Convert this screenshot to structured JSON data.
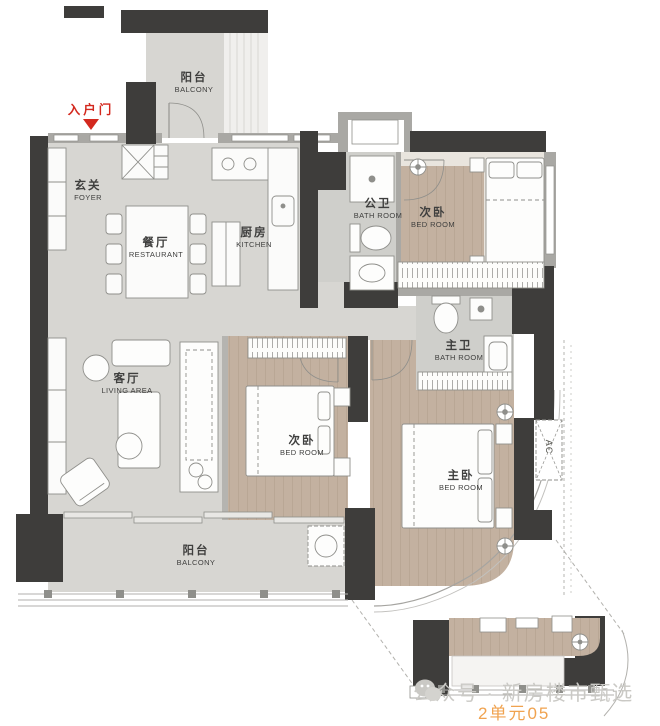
{
  "plan": {
    "entrance_label": "入户门",
    "ac_label": "AC",
    "rooms": [
      {
        "id": "balcony-top",
        "zh": "阳台",
        "en": "BALCONY"
      },
      {
        "id": "foyer",
        "zh": "玄关",
        "en": "FOYER"
      },
      {
        "id": "dining",
        "zh": "餐厅",
        "en": "RESTAURANT"
      },
      {
        "id": "kitchen",
        "zh": "厨房",
        "en": "KITCHEN"
      },
      {
        "id": "bath-public",
        "zh": "公卫",
        "en": "BATH ROOM"
      },
      {
        "id": "bedroom-second-top",
        "zh": "次卧",
        "en": "BED ROOM"
      },
      {
        "id": "bath-master",
        "zh": "主卫",
        "en": "BATH ROOM"
      },
      {
        "id": "living",
        "zh": "客厅",
        "en": "LIVING AREA"
      },
      {
        "id": "bedroom-second-mid",
        "zh": "次卧",
        "en": "BED ROOM"
      },
      {
        "id": "bedroom-master",
        "zh": "主卧",
        "en": "BED ROOM"
      },
      {
        "id": "balcony-bottom",
        "zh": "阳台",
        "en": "BALCONY"
      }
    ]
  },
  "watermark": {
    "publisher": "公众号 · 新房楼市甄选",
    "unit": "2单元05"
  },
  "colors": {
    "wall": "#3e3d3b",
    "floor_gray": "#d7d6d2",
    "floor_bath": "#cfcfcb",
    "floor_wood": "#c3b1a0",
    "entrance_red": "#d3281e",
    "watermark_gray": "#cac9c5",
    "unit_orange": "#f0a350"
  }
}
